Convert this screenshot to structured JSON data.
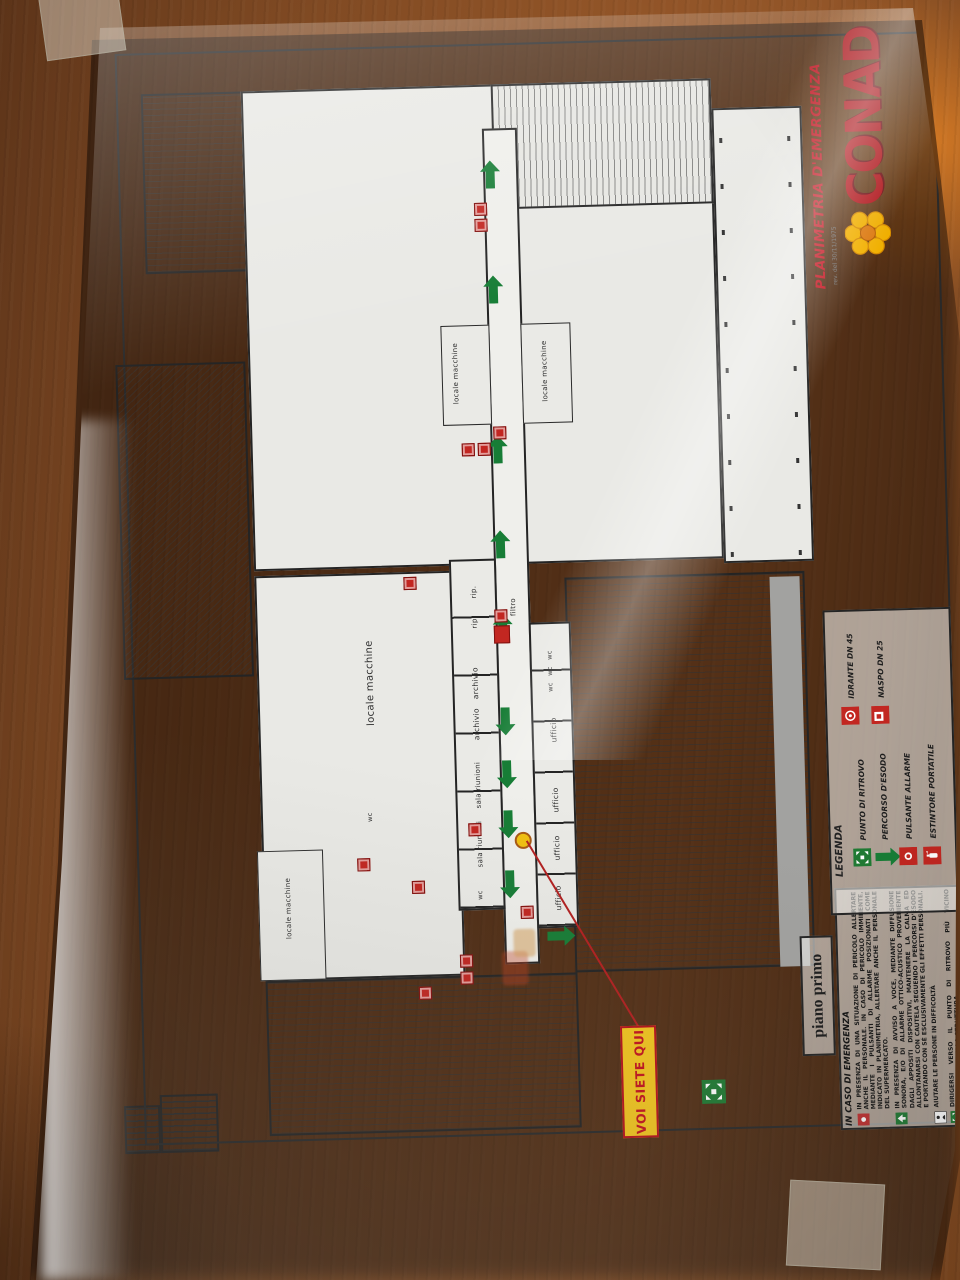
{
  "document": {
    "brand": "CONAD",
    "title": "PLANIMETRIA D'EMERGENZA",
    "revision": "rev. del 30/11/1975",
    "floor_label": "piano primo",
    "you_are_here": "VOI SIETE QUI"
  },
  "legend": {
    "title": "LEGENDA",
    "items": [
      {
        "label": "PUNTO DI RITROVO",
        "icon": "assembly-point-icon",
        "color": "#1f7a33"
      },
      {
        "label": "PERCORSO D'ESODO",
        "icon": "escape-route-arrow-icon",
        "color": "#1f7a33"
      },
      {
        "label": "PULSANTE ALLARME",
        "icon": "alarm-button-icon",
        "color": "#c22721"
      },
      {
        "label": "ESTINTORE PORTATILE",
        "icon": "fire-extinguisher-icon",
        "color": "#c22721"
      },
      {
        "label": "IDRANTE DN 45",
        "icon": "hydrant-icon",
        "color": "#c22721"
      },
      {
        "label": "NASPO DN 25",
        "icon": "hose-reel-icon",
        "color": "#c22721"
      }
    ]
  },
  "emergency_instructions": {
    "title": "IN CASO DI EMERGENZA",
    "items": [
      {
        "icon": "alarm-button-icon",
        "color": "#c03030",
        "text": "IN PRESENZA DI UNA SITUAZIONE DI PERICOLO ALLERTARE ANCHE IL PERSONALE. IN CASO DI PERICOLO IMMINENTE, MEDIANTE I PULSANTI DI ALLARME POSIZIONATI COME INDICATO IN PLANIMETRIA, ALLERTARE ANCHE IL PERSONALE DEL SUPERMERCATO."
      },
      {
        "icon": "escape-route-icon",
        "color": "#1f7a33",
        "text": "IN PRESENZA DI AVVISO A VOCE, MEDIANTE DIFFUSIONE SONORA, E/O DI ALLARME OTTICO-ACUSTICO PROVENIENTE DAGLI APPOSITI DISPOSITIVI, MANTENERE LA CALMA ED ALLONTANARSI CON CAUTELA SEGUENDO I PERCORSI D'ESODO E PORTANDO CON SÉ ESCLUSIVAMENTE GLI EFFETTI PERSONALI."
      },
      {
        "icon": "assist-person-icon",
        "color": "#222222",
        "text": "AIUTARE LE PERSONE IN DIFFICOLTÀ"
      },
      {
        "icon": "assembly-point-icon",
        "color": "#1f7a33",
        "text": "DIRIGERSI VERSO IL PUNTO DI RITROVO PIÙ VICINO ALL'ESTERNO DELLA STRUTTURA."
      }
    ]
  },
  "rooms": [
    "locale macchine",
    "locale macchine",
    "locale macchine",
    "locale macchine",
    "rip.",
    "rip.",
    "archivio",
    "archivio",
    "sala riunioni",
    "sala riunioni",
    "filtro",
    "wc",
    "wc",
    "wc",
    "wc",
    "ufficio",
    "ufficio",
    "ufficio",
    "ufficio",
    "wc"
  ],
  "colors": {
    "exit_green": "#1f7a33",
    "safety_red": "#c22721",
    "you_are_here_yellow": "#f2c51f",
    "brand_red": "#b31218",
    "flower_yellow": "#f5b301"
  }
}
